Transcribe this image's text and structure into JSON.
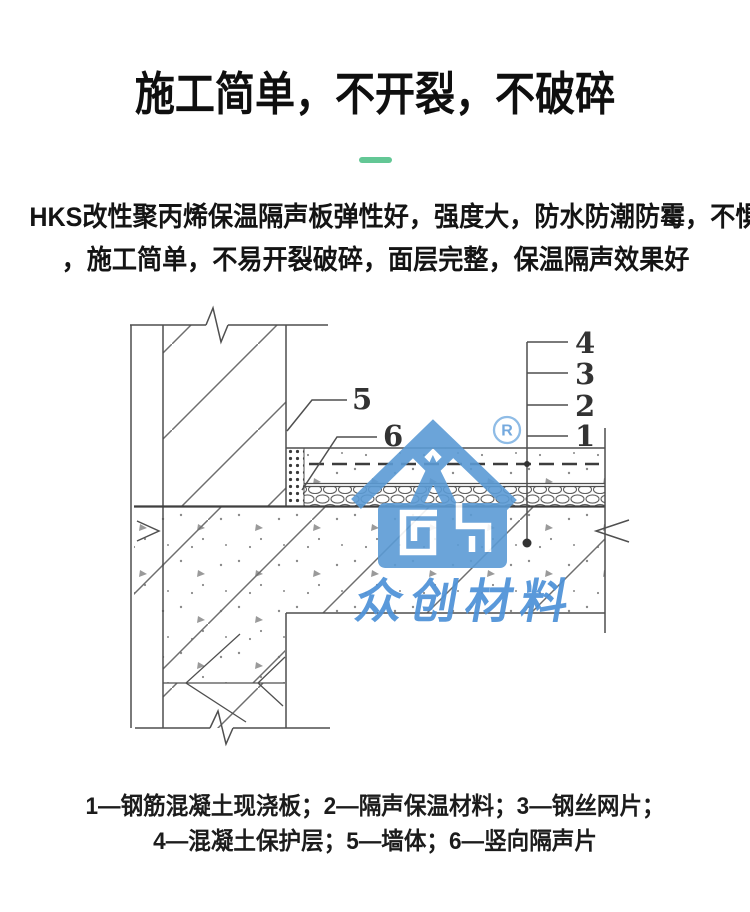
{
  "header": {
    "title": "施工简单，不开裂，不破碎",
    "divider_color": "#63C795"
  },
  "description": {
    "line1": "HKS改性聚丙烯保温隔声板弹性好，强度大，防水防潮防霉，不惧重压",
    "line2": "，施工简单，不易开裂破碎，面层完整，保温隔声效果好"
  },
  "diagram": {
    "callouts": {
      "c1": "1",
      "c2": "2",
      "c3": "3",
      "c4": "4",
      "c5": "5",
      "c6": "6"
    },
    "watermark": {
      "brand": "众创材料",
      "registered": "R",
      "logo_color": "#5B9BD5",
      "text_color": "#4E92D8"
    },
    "line_color": "#4f4f4f"
  },
  "caption": {
    "line1": "1—钢筋混凝土现浇板；2—隔声保温材料；3—钢丝网片；",
    "line2": "4—混凝土保护层；5—墙体；6—竖向隔声片"
  }
}
